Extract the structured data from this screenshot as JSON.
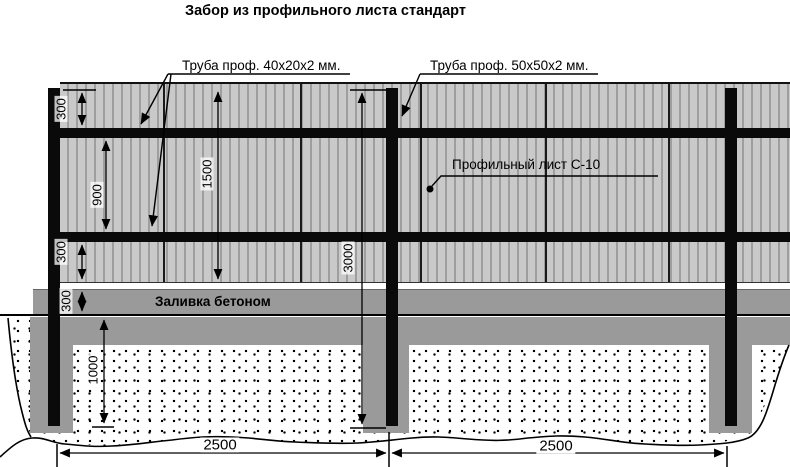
{
  "title": "Забор из профильного листа стандарт",
  "callouts": {
    "rail_tube": "Труба проф. 40х20х2 мм.",
    "post_tube": "Труба проф. 50х50х2 мм.",
    "sheet": "Профильный лист С-10",
    "concrete_fill": "Заливка бетоном"
  },
  "dimensions": {
    "top_rail_offset": "300",
    "rails_spacing": "900",
    "bottom_rail_offset": "300",
    "plinth_height": "300",
    "sheet_height": "1500",
    "post_length": "3000",
    "embedment_depth": "1000",
    "span_left": "2500",
    "span_right": "2500"
  },
  "colors": {
    "sheet": "#c9c9c9",
    "sheet_ridge": "#9e9e9e",
    "concrete": "#9a9a9a",
    "line": "#000000"
  }
}
